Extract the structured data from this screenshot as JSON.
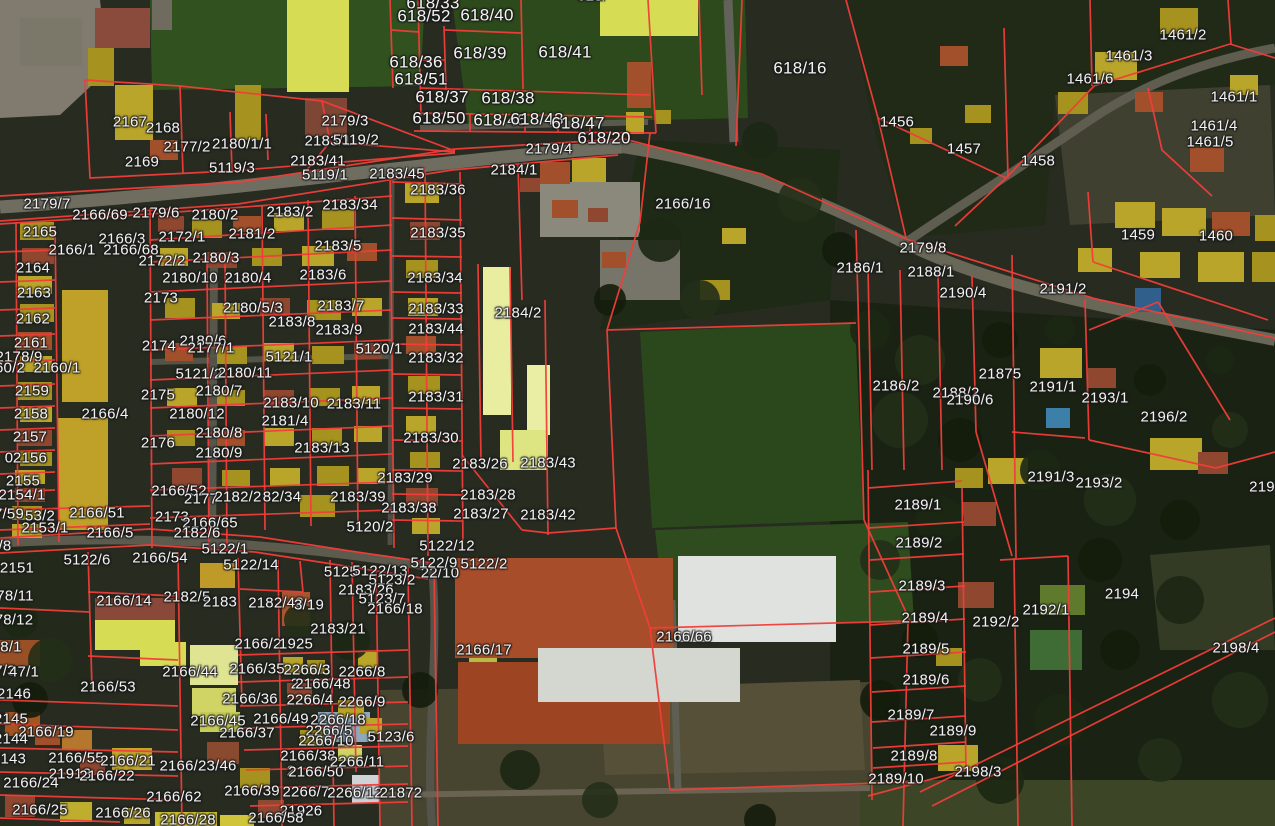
{
  "map": {
    "colors": {
      "parcel_line": "#f13d39",
      "label_text": "#f4f4f4",
      "label_halo": "#1e1e1e"
    },
    "labels": [
      {
        "t": "618/",
        "x": 592,
        "y": -4
      },
      {
        "t": "618/33",
        "x": 433,
        "y": 3,
        "s": 17
      },
      {
        "t": "618/52",
        "x": 424,
        "y": 16,
        "s": 17
      },
      {
        "t": "618/40",
        "x": 487,
        "y": 15,
        "s": 17
      },
      {
        "t": "618/39",
        "x": 480,
        "y": 53,
        "s": 17
      },
      {
        "t": "618/41",
        "x": 565,
        "y": 52,
        "s": 17
      },
      {
        "t": "618/36",
        "x": 416,
        "y": 62,
        "s": 17
      },
      {
        "t": "618/51",
        "x": 421,
        "y": 79,
        "s": 17
      },
      {
        "t": "618/37",
        "x": 442,
        "y": 97,
        "s": 17
      },
      {
        "t": "618/38",
        "x": 508,
        "y": 98,
        "s": 17
      },
      {
        "t": "618/50",
        "x": 439,
        "y": 118,
        "s": 17
      },
      {
        "t": "618/46",
        "x": 500,
        "y": 120,
        "s": 17
      },
      {
        "t": "618/48",
        "x": 537,
        "y": 119,
        "s": 17
      },
      {
        "t": "618/47",
        "x": 578,
        "y": 123,
        "s": 17
      },
      {
        "t": "618/20",
        "x": 604,
        "y": 138,
        "s": 17
      },
      {
        "t": "618/16",
        "x": 800,
        "y": 68,
        "s": 17
      },
      {
        "t": "2179/4",
        "x": 549,
        "y": 149
      },
      {
        "t": "2184/1",
        "x": 514,
        "y": 170
      },
      {
        "t": "2183/36",
        "x": 438,
        "y": 190
      },
      {
        "t": "2166/16",
        "x": 683,
        "y": 204
      },
      {
        "t": "2183/35",
        "x": 438,
        "y": 233
      },
      {
        "t": "1461/2",
        "x": 1183,
        "y": 35
      },
      {
        "t": "1461/3",
        "x": 1129,
        "y": 56
      },
      {
        "t": "1461/6",
        "x": 1090,
        "y": 79
      },
      {
        "t": "1461/1",
        "x": 1234,
        "y": 97
      },
      {
        "t": "1456",
        "x": 897,
        "y": 122
      },
      {
        "t": "1461/4",
        "x": 1214,
        "y": 126
      },
      {
        "t": "1461/5",
        "x": 1210,
        "y": 142
      },
      {
        "t": "1457",
        "x": 964,
        "y": 149
      },
      {
        "t": "1458",
        "x": 1038,
        "y": 161
      },
      {
        "t": "1459",
        "x": 1138,
        "y": 235
      },
      {
        "t": "1460",
        "x": 1216,
        "y": 236
      },
      {
        "t": "2179/8",
        "x": 923,
        "y": 248
      },
      {
        "t": "2186/1",
        "x": 860,
        "y": 268
      },
      {
        "t": "2188/1",
        "x": 931,
        "y": 272
      },
      {
        "t": "2190/4",
        "x": 963,
        "y": 293
      },
      {
        "t": "2191/2",
        "x": 1063,
        "y": 289
      },
      {
        "t": "2167",
        "x": 130,
        "y": 122
      },
      {
        "t": "2168",
        "x": 163,
        "y": 128
      },
      {
        "t": "2177/2",
        "x": 187,
        "y": 147
      },
      {
        "t": "2180/1/1",
        "x": 242,
        "y": 144
      },
      {
        "t": "2169",
        "x": 142,
        "y": 162
      },
      {
        "t": "5119/3",
        "x": 232,
        "y": 168
      },
      {
        "t": "2179/3",
        "x": 345,
        "y": 121
      },
      {
        "t": "2183/1",
        "x": 328,
        "y": 141
      },
      {
        "t": "5119/2",
        "x": 356,
        "y": 140
      },
      {
        "t": "2183/41",
        "x": 318,
        "y": 161
      },
      {
        "t": "5119/1",
        "x": 325,
        "y": 175
      },
      {
        "t": "2183/45",
        "x": 397,
        "y": 174
      },
      {
        "t": "2179/7",
        "x": 47,
        "y": 204
      },
      {
        "t": "2166/69",
        "x": 100,
        "y": 215
      },
      {
        "t": "2179/6",
        "x": 156,
        "y": 213
      },
      {
        "t": "2180/2",
        "x": 215,
        "y": 215
      },
      {
        "t": "2183/2",
        "x": 290,
        "y": 212
      },
      {
        "t": "2183/34",
        "x": 350,
        "y": 205
      },
      {
        "t": "2165",
        "x": 40,
        "y": 232
      },
      {
        "t": "2166/3",
        "x": 122,
        "y": 239
      },
      {
        "t": "2172/1",
        "x": 182,
        "y": 237
      },
      {
        "t": "2181/2",
        "x": 252,
        "y": 234
      },
      {
        "t": "2166/1",
        "x": 72,
        "y": 250
      },
      {
        "t": "2166/68",
        "x": 131,
        "y": 250
      },
      {
        "t": "2183/5",
        "x": 338,
        "y": 246
      },
      {
        "t": "2172/2",
        "x": 162,
        "y": 261
      },
      {
        "t": "2180/3",
        "x": 216,
        "y": 258
      },
      {
        "t": "2164",
        "x": 33,
        "y": 268
      },
      {
        "t": "2163",
        "x": 34,
        "y": 293
      },
      {
        "t": "2173",
        "x": 161,
        "y": 298
      },
      {
        "t": "2180/10",
        "x": 190,
        "y": 278
      },
      {
        "t": "2180/4",
        "x": 248,
        "y": 278
      },
      {
        "t": "2183/6",
        "x": 323,
        "y": 275
      },
      {
        "t": "2180/5/3",
        "x": 253,
        "y": 308
      },
      {
        "t": "2183/7",
        "x": 341,
        "y": 306
      },
      {
        "t": "2162",
        "x": 33,
        "y": 319
      },
      {
        "t": "2183/8",
        "x": 292,
        "y": 322
      },
      {
        "t": "2183/9",
        "x": 339,
        "y": 330
      },
      {
        "t": "2161",
        "x": 31,
        "y": 343
      },
      {
        "t": "2174",
        "x": 159,
        "y": 346
      },
      {
        "t": "2180/6",
        "x": 203,
        "y": 341
      },
      {
        "t": "2177/1",
        "x": 211,
        "y": 348
      },
      {
        "t": "5120/1",
        "x": 379,
        "y": 349
      },
      {
        "t": "2178/9",
        "x": 19,
        "y": 357
      },
      {
        "t": "60/2",
        "x": 10,
        "y": 368
      },
      {
        "t": "2160/1",
        "x": 57,
        "y": 368
      },
      {
        "t": "5121/1",
        "x": 289,
        "y": 357
      },
      {
        "t": "5121/2",
        "x": 199,
        "y": 374
      },
      {
        "t": "2180/11",
        "x": 245,
        "y": 373
      },
      {
        "t": "2159",
        "x": 32,
        "y": 391
      },
      {
        "t": "2175",
        "x": 158,
        "y": 395
      },
      {
        "t": "2180/7",
        "x": 219,
        "y": 391
      },
      {
        "t": "2183/10",
        "x": 291,
        "y": 403
      },
      {
        "t": "2183/11",
        "x": 354,
        "y": 404
      },
      {
        "t": "2158",
        "x": 31,
        "y": 414
      },
      {
        "t": "2166/4",
        "x": 105,
        "y": 414
      },
      {
        "t": "2180/12",
        "x": 197,
        "y": 414
      },
      {
        "t": "2181/4",
        "x": 285,
        "y": 421
      },
      {
        "t": "2157",
        "x": 30,
        "y": 437
      },
      {
        "t": "2180/8",
        "x": 219,
        "y": 433
      },
      {
        "t": "2176",
        "x": 158,
        "y": 443
      },
      {
        "t": "2183/13",
        "x": 322,
        "y": 448
      },
      {
        "t": "0",
        "x": 9,
        "y": 458
      },
      {
        "t": "2156",
        "x": 30,
        "y": 458
      },
      {
        "t": "2180/9",
        "x": 219,
        "y": 453
      },
      {
        "t": "2155",
        "x": 23,
        "y": 481
      },
      {
        "t": "2154/1",
        "x": 22,
        "y": 495
      },
      {
        "t": "2166/52",
        "x": 179,
        "y": 491
      },
      {
        "t": "2177",
        "x": 201,
        "y": 499
      },
      {
        "t": "2182/2",
        "x": 238,
        "y": 497
      },
      {
        "t": "82/34",
        "x": 282,
        "y": 497
      },
      {
        "t": "2183/39",
        "x": 358,
        "y": 497
      },
      {
        "t": "2183/29",
        "x": 405,
        "y": 478
      },
      {
        "t": "2183/38",
        "x": 409,
        "y": 508
      },
      {
        "t": "2166/51",
        "x": 97,
        "y": 513
      },
      {
        "t": "7/59",
        "x": 9,
        "y": 514
      },
      {
        "t": "53/2",
        "x": 40,
        "y": 516
      },
      {
        "t": "2153/1",
        "x": 45,
        "y": 528
      },
      {
        "t": "2166/5",
        "x": 110,
        "y": 533
      },
      {
        "t": "2173",
        "x": 172,
        "y": 517
      },
      {
        "t": "2166/65",
        "x": 210,
        "y": 523
      },
      {
        "t": "2182/6",
        "x": 197,
        "y": 533
      },
      {
        "t": "5120/2",
        "x": 370,
        "y": 527
      },
      {
        "t": "5122/1",
        "x": 225,
        "y": 549
      },
      {
        "t": "2184/2",
        "x": 518,
        "y": 313
      },
      {
        "t": "2183/34",
        "x": 435,
        "y": 278
      },
      {
        "t": "2183/33",
        "x": 436,
        "y": 309
      },
      {
        "t": "2183/44",
        "x": 436,
        "y": 329
      },
      {
        "t": "2183/32",
        "x": 436,
        "y": 358
      },
      {
        "t": "2183/31",
        "x": 436,
        "y": 397
      },
      {
        "t": "2183/30",
        "x": 431,
        "y": 438
      },
      {
        "t": "2183/26",
        "x": 480,
        "y": 464
      },
      {
        "t": "2183/43",
        "x": 548,
        "y": 463
      },
      {
        "t": "2183/28",
        "x": 488,
        "y": 495
      },
      {
        "t": "2183/27",
        "x": 481,
        "y": 514
      },
      {
        "t": "2183/42",
        "x": 548,
        "y": 515
      },
      {
        "t": "21875",
        "x": 1000,
        "y": 374
      },
      {
        "t": "2186/2",
        "x": 896,
        "y": 386
      },
      {
        "t": "2188/2",
        "x": 956,
        "y": 393
      },
      {
        "t": "2190/6",
        "x": 970,
        "y": 400
      },
      {
        "t": "2191/1",
        "x": 1053,
        "y": 387
      },
      {
        "t": "2193/1",
        "x": 1105,
        "y": 398
      },
      {
        "t": "2196/2",
        "x": 1164,
        "y": 417
      },
      {
        "t": "2191/3",
        "x": 1051,
        "y": 477
      },
      {
        "t": "2193/2",
        "x": 1099,
        "y": 483
      },
      {
        "t": "2189/1",
        "x": 918,
        "y": 505
      },
      {
        "t": "219",
        "x": 1262,
        "y": 487
      },
      {
        "t": "2189/2",
        "x": 919,
        "y": 543
      },
      {
        "t": "/8",
        "x": 5,
        "y": 546
      },
      {
        "t": "5122/6",
        "x": 87,
        "y": 560
      },
      {
        "t": "2166/54",
        "x": 160,
        "y": 558
      },
      {
        "t": "5122/14",
        "x": 251,
        "y": 565
      },
      {
        "t": "2151",
        "x": 17,
        "y": 568
      },
      {
        "t": "5125",
        "x": 341,
        "y": 572
      },
      {
        "t": "5122/13",
        "x": 380,
        "y": 571
      },
      {
        "t": "5123/2",
        "x": 392,
        "y": 580
      },
      {
        "t": "22/10",
        "x": 440,
        "y": 573
      },
      {
        "t": "2183/26",
        "x": 366,
        "y": 590
      },
      {
        "t": "5123/7",
        "x": 382,
        "y": 599
      },
      {
        "t": "2166/18",
        "x": 395,
        "y": 609
      },
      {
        "t": "78/11",
        "x": 15,
        "y": 596
      },
      {
        "t": "78/12",
        "x": 14,
        "y": 620
      },
      {
        "t": "2166/14",
        "x": 124,
        "y": 601
      },
      {
        "t": "2182/5",
        "x": 187,
        "y": 597
      },
      {
        "t": "2183",
        "x": 220,
        "y": 602
      },
      {
        "t": "2182/43",
        "x": 276,
        "y": 603
      },
      {
        "t": "3/19",
        "x": 309,
        "y": 605
      },
      {
        "t": "2183/21",
        "x": 338,
        "y": 629
      },
      {
        "t": "2166/2",
        "x": 258,
        "y": 644
      },
      {
        "t": "1925",
        "x": 296,
        "y": 644
      },
      {
        "t": "8/1",
        "x": 11,
        "y": 647
      },
      {
        "t": "2166/44",
        "x": 190,
        "y": 672
      },
      {
        "t": "2166/35",
        "x": 257,
        "y": 669
      },
      {
        "t": "2266/3",
        "x": 307,
        "y": 670
      },
      {
        "t": "2266/8",
        "x": 362,
        "y": 672
      },
      {
        "t": "7/3",
        "x": 5,
        "y": 671
      },
      {
        "t": "47/1",
        "x": 24,
        "y": 672
      },
      {
        "t": "2146",
        "x": 14,
        "y": 694
      },
      {
        "t": "2166/53",
        "x": 108,
        "y": 687
      },
      {
        "t": "2",
        "x": 295,
        "y": 684
      },
      {
        "t": "2166/48",
        "x": 323,
        "y": 684
      },
      {
        "t": "2166/36",
        "x": 250,
        "y": 699
      },
      {
        "t": "2266/4",
        "x": 310,
        "y": 700
      },
      {
        "t": "2266/9",
        "x": 362,
        "y": 702
      },
      {
        "t": "2145",
        "x": 11,
        "y": 719
      },
      {
        "t": "2166/45",
        "x": 218,
        "y": 721
      },
      {
        "t": "2166/49",
        "x": 281,
        "y": 719
      },
      {
        "t": "2266/18",
        "x": 338,
        "y": 720
      },
      {
        "t": "2166/19",
        "x": 46,
        "y": 732
      },
      {
        "t": "2144",
        "x": 11,
        "y": 739
      },
      {
        "t": "2166/37",
        "x": 247,
        "y": 733
      },
      {
        "t": "2266/5",
        "x": 329,
        "y": 731
      },
      {
        "t": "2266/10",
        "x": 326,
        "y": 741
      },
      {
        "t": "5123/6",
        "x": 391,
        "y": 737
      },
      {
        "t": "2143",
        "x": 9,
        "y": 759
      },
      {
        "t": "2166/55",
        "x": 76,
        "y": 758
      },
      {
        "t": "2166/21",
        "x": 128,
        "y": 761
      },
      {
        "t": "21913",
        "x": 70,
        "y": 774
      },
      {
        "t": "2166/22",
        "x": 107,
        "y": 776
      },
      {
        "t": "2166/23/46",
        "x": 198,
        "y": 766
      },
      {
        "t": "2166/24",
        "x": 31,
        "y": 783
      },
      {
        "t": "2166/38",
        "x": 308,
        "y": 756
      },
      {
        "t": "2",
        "x": 291,
        "y": 771
      },
      {
        "t": "2166/50",
        "x": 316,
        "y": 772
      },
      {
        "t": "2266/11",
        "x": 357,
        "y": 762
      },
      {
        "t": "2166/62",
        "x": 174,
        "y": 797
      },
      {
        "t": "2166/39",
        "x": 252,
        "y": 791
      },
      {
        "t": "2266/7",
        "x": 306,
        "y": 792
      },
      {
        "t": "2266/12",
        "x": 355,
        "y": 793
      },
      {
        "t": "21872",
        "x": 401,
        "y": 793
      },
      {
        "t": "2166/25",
        "x": 40,
        "y": 810
      },
      {
        "t": "2166/26",
        "x": 123,
        "y": 813
      },
      {
        "t": "2166/28",
        "x": 188,
        "y": 820
      },
      {
        "t": "21926",
        "x": 301,
        "y": 811
      },
      {
        "t": "2166/58",
        "x": 276,
        "y": 818
      },
      {
        "t": "5122/12",
        "x": 447,
        "y": 546
      },
      {
        "t": "5122/9",
        "x": 434,
        "y": 563
      },
      {
        "t": "5122/2",
        "x": 484,
        "y": 564
      },
      {
        "t": "2166/17",
        "x": 484,
        "y": 650
      },
      {
        "t": "2166/66",
        "x": 684,
        "y": 637
      },
      {
        "t": "2189/3",
        "x": 922,
        "y": 586
      },
      {
        "t": "2192/1",
        "x": 1046,
        "y": 610
      },
      {
        "t": "2192/2",
        "x": 996,
        "y": 622
      },
      {
        "t": "2194",
        "x": 1122,
        "y": 594
      },
      {
        "t": "2189/4",
        "x": 925,
        "y": 618
      },
      {
        "t": "2189/5",
        "x": 926,
        "y": 649
      },
      {
        "t": "2198/4",
        "x": 1236,
        "y": 648
      },
      {
        "t": "2189/6",
        "x": 926,
        "y": 680
      },
      {
        "t": "2189/7",
        "x": 911,
        "y": 715
      },
      {
        "t": "2189/9",
        "x": 953,
        "y": 731
      },
      {
        "t": "2189/8",
        "x": 914,
        "y": 756
      },
      {
        "t": "2198/3",
        "x": 978,
        "y": 772
      },
      {
        "t": "2189/10",
        "x": 896,
        "y": 779
      }
    ]
  }
}
